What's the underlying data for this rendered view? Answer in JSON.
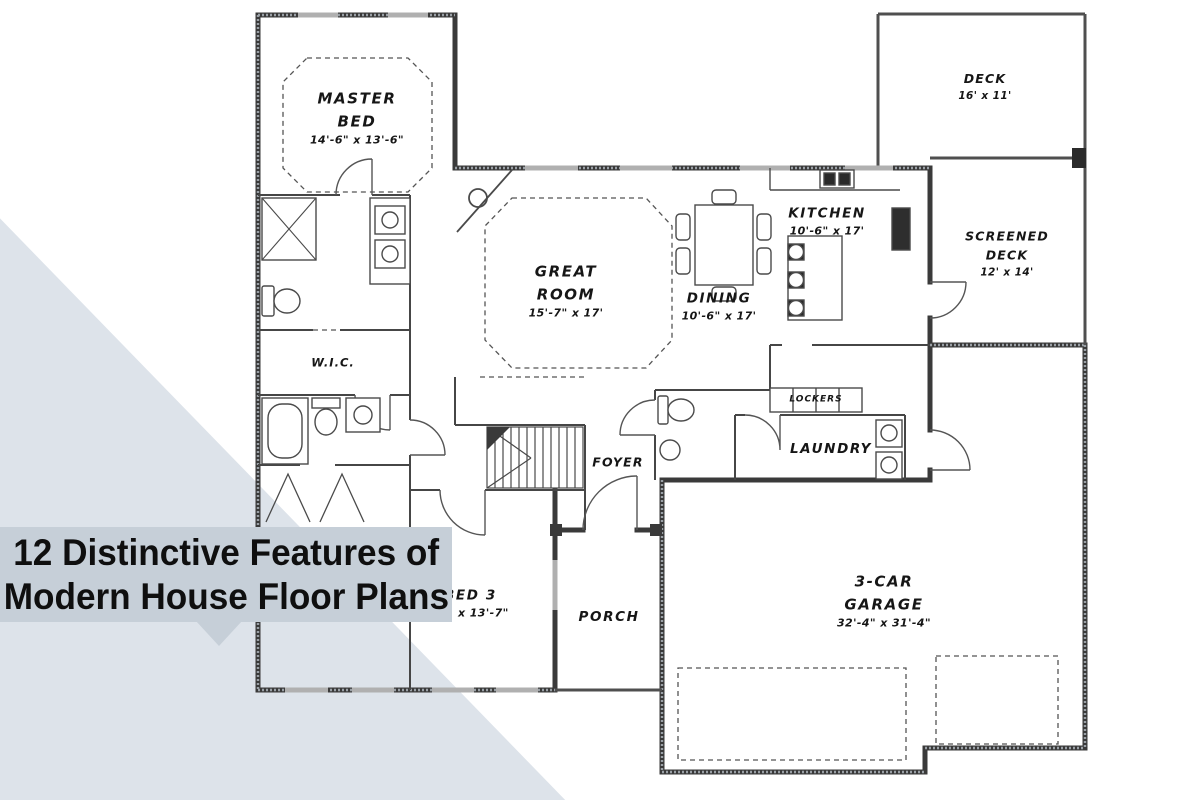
{
  "overlay": {
    "title_line1": "12 Distinctive Features of",
    "title_line2": "Modern House Floor Plans"
  },
  "colors": {
    "background": "#ffffff",
    "wedge": "#dde3ea",
    "title_band": "#c6cfd8",
    "title_text": "#0f0f0f",
    "exterior_wall": "#3a3a3a",
    "plan_line": "#4a4a4a"
  },
  "floor_plan": {
    "master_bed": {
      "line1": "MASTER",
      "line2": "BED",
      "dims": "14'-6\" x 13'-6\""
    },
    "great_room": {
      "line1": "GREAT",
      "line2": "ROOM",
      "dims": "15'-7\" x 17'"
    },
    "dining": {
      "line1": "DINING",
      "dims": "10'-6\" x 17'"
    },
    "kitchen": {
      "line1": "KITCHEN",
      "dims": "10'-6\" x 17'"
    },
    "deck": {
      "line1": "DECK",
      "dims": "16' x 11'"
    },
    "screened_deck": {
      "line1": "SCREENED",
      "line2": "DECK",
      "dims": "12' x 14'"
    },
    "wic": {
      "line1": "W.I.C."
    },
    "lockers": {
      "line1": "LOCKERS"
    },
    "laundry": {
      "line1": "LAUNDRY"
    },
    "foyer": {
      "line1": "FOYER"
    },
    "bed3": {
      "line1": "BED 3",
      "dims": "x 13'-7\""
    },
    "porch": {
      "line1": "PORCH"
    },
    "garage": {
      "line1": "3-CAR",
      "line2": "GARAGE",
      "dims": "32'-4\" x 31'-4\""
    }
  }
}
